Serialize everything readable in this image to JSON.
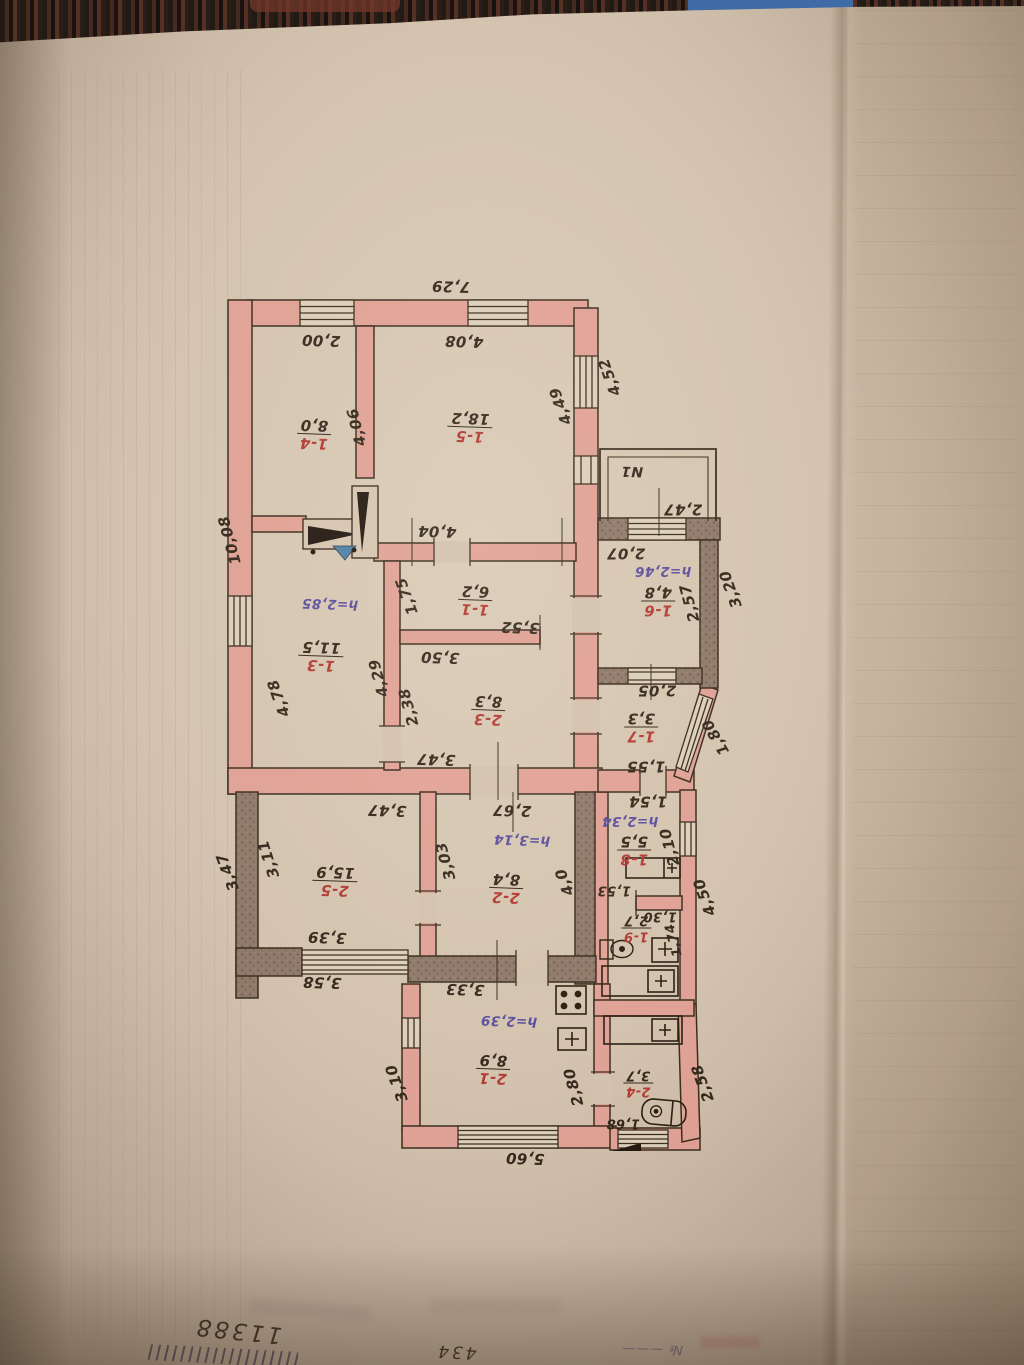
{
  "palette": {
    "paper": "#d2c2ae",
    "wall_pink": "#e0a195",
    "wall_dark": "#8e7869",
    "ink": "#33281b",
    "room_number_red": "#b23a32",
    "height_note_purple": "#5b4f9e",
    "fabric_blue": "#3f6ba6"
  },
  "icons": [
    {
      "name": "cooker-icon",
      "shape": "square-with-four-dots"
    },
    {
      "name": "heater-icon",
      "shape": "square-with-plus"
    },
    {
      "name": "toilet-icon",
      "shape": "cistern-and-bowl"
    },
    {
      "name": "sink-icon",
      "shape": "rounded-basin-with-drain"
    },
    {
      "name": "masonry-stove-icon",
      "shape": "black-wedge-pair-with-blue-triangle"
    },
    {
      "name": "window-vent-icon",
      "shape": "long-rect-with-plus-cell"
    }
  ],
  "plan": {
    "note": "hand-drawn BTI floor plan photographed upside down; all lettering appears rotated 180 degrees",
    "labels": [
      {
        "name": "dim-total-top",
        "kind": "dim",
        "text": "7,29",
        "x": 451,
        "y": 286,
        "rot": 182
      },
      {
        "name": "dim-1-4-width",
        "kind": "dim",
        "text": "2,00",
        "x": 321,
        "y": 340,
        "rot": 182
      },
      {
        "name": "dim-1-5-width",
        "kind": "dim",
        "text": "4,08",
        "x": 464,
        "y": 341,
        "rot": 182
      },
      {
        "name": "dim-right-outer-upper",
        "kind": "dim",
        "text": "4,52",
        "x": 610,
        "y": 377,
        "rot": 250
      },
      {
        "name": "dim-1-5-depth",
        "kind": "dim",
        "text": "4,49",
        "x": 561,
        "y": 406,
        "rot": 250
      },
      {
        "name": "dim-1-4-depth",
        "kind": "dim",
        "text": "4,06",
        "x": 357,
        "y": 427,
        "rot": 256
      },
      {
        "name": "dim-left-outer-upper",
        "kind": "dim",
        "text": "10,08",
        "x": 230,
        "y": 540,
        "rot": 255
      },
      {
        "name": "dim-1-1-width-top",
        "kind": "dim",
        "text": "4,04",
        "x": 437,
        "y": 531,
        "rot": 182
      },
      {
        "name": "veranda-label",
        "kind": "dim",
        "text": "N1",
        "x": 632,
        "y": 471,
        "rot": 182,
        "size": 14
      },
      {
        "name": "dim-veranda-width",
        "kind": "dim",
        "text": "2,47",
        "x": 683,
        "y": 509,
        "rot": 180
      },
      {
        "name": "dim-1-6-window",
        "kind": "dim",
        "text": "2,07",
        "x": 626,
        "y": 553,
        "rot": 180
      },
      {
        "name": "height-1-6",
        "kind": "height",
        "text": "h=2,46",
        "x": 663,
        "y": 570,
        "rot": 180
      },
      {
        "name": "dim-1-6-depth",
        "kind": "dim",
        "text": "2,57",
        "x": 690,
        "y": 603,
        "rot": 255
      },
      {
        "name": "dim-annex-outer-right",
        "kind": "dim",
        "text": "3,20",
        "x": 731,
        "y": 589,
        "rot": 250
      },
      {
        "name": "dim-1-1-left",
        "kind": "dim",
        "text": "1,75",
        "x": 407,
        "y": 596,
        "rot": 250
      },
      {
        "name": "dim-1-1-width-bottom",
        "kind": "dim",
        "text": "3,52",
        "x": 520,
        "y": 627,
        "rot": 182
      },
      {
        "name": "height-1-3",
        "kind": "height",
        "text": "h=2,85",
        "x": 330,
        "y": 603,
        "rot": 182
      },
      {
        "name": "dim-1-6-bottom-window",
        "kind": "dim",
        "text": "2,05",
        "x": 657,
        "y": 690,
        "rot": 180
      },
      {
        "name": "dim-2-3-width-top",
        "kind": "dim",
        "text": "3,50",
        "x": 440,
        "y": 657,
        "rot": 182
      },
      {
        "name": "dim-2-3-left",
        "kind": "dim",
        "text": "2,38",
        "x": 409,
        "y": 707,
        "rot": 255
      },
      {
        "name": "dim-1-3-right",
        "kind": "dim",
        "text": "4,29",
        "x": 379,
        "y": 678,
        "rot": 255
      },
      {
        "name": "dim-1-3-left",
        "kind": "dim",
        "text": "4,78",
        "x": 279,
        "y": 698,
        "rot": 250
      },
      {
        "name": "dim-diagonal-wall",
        "kind": "dim",
        "text": "1,80",
        "x": 716,
        "y": 737,
        "rot": 240
      },
      {
        "name": "dim-1-7-bottom",
        "kind": "dim",
        "text": "1,55",
        "x": 646,
        "y": 766,
        "rot": 180
      },
      {
        "name": "dim-2-3-width-bottom",
        "kind": "dim",
        "text": "3,47",
        "x": 436,
        "y": 759,
        "rot": 182
      },
      {
        "name": "dim-1-8-top",
        "kind": "dim",
        "text": "1,54",
        "x": 648,
        "y": 801,
        "rot": 180
      },
      {
        "name": "height-1-8",
        "kind": "height",
        "text": "h=2,34",
        "x": 630,
        "y": 820,
        "rot": 180
      },
      {
        "name": "dim-1-8-right",
        "kind": "dim",
        "text": "2,10",
        "x": 670,
        "y": 847,
        "rot": 255
      },
      {
        "name": "dim-right-outer-lower",
        "kind": "dim",
        "text": "4,50",
        "x": 705,
        "y": 897,
        "rot": 250
      },
      {
        "name": "dim-1-9-top",
        "kind": "dim",
        "text": "1,53",
        "x": 614,
        "y": 890,
        "rot": 180,
        "size": 13
      },
      {
        "name": "dim-1-9-niche",
        "kind": "dim",
        "text": "1,30",
        "x": 660,
        "y": 916,
        "rot": 180,
        "size": 13
      },
      {
        "name": "dim-1-9-right",
        "kind": "dim",
        "text": "1,74",
        "x": 674,
        "y": 940,
        "rot": 255,
        "size": 13
      },
      {
        "name": "dim-2-5-width-top",
        "kind": "dim",
        "text": "3,47",
        "x": 387,
        "y": 810,
        "rot": 182
      },
      {
        "name": "dim-2-2-width-top",
        "kind": "dim",
        "text": "2,67",
        "x": 512,
        "y": 810,
        "rot": 182
      },
      {
        "name": "height-2-2",
        "kind": "height",
        "text": "h=3,14",
        "x": 522,
        "y": 839,
        "rot": 182
      },
      {
        "name": "dim-2-5-left",
        "kind": "dim",
        "text": "3,11",
        "x": 269,
        "y": 859,
        "rot": 252
      },
      {
        "name": "dim-left-outer-lower",
        "kind": "dim",
        "text": "3,47",
        "x": 228,
        "y": 872,
        "rot": 250
      },
      {
        "name": "dim-2-2-left",
        "kind": "dim",
        "text": "3,03",
        "x": 446,
        "y": 861,
        "rot": 255
      },
      {
        "name": "dim-2-2-right",
        "kind": "dim",
        "text": "4,0",
        "x": 565,
        "y": 882,
        "rot": 250
      },
      {
        "name": "dim-2-5-window",
        "kind": "dim",
        "text": "3,39",
        "x": 327,
        "y": 937,
        "rot": 182
      },
      {
        "name": "dim-2-5-outer-bottom",
        "kind": "dim",
        "text": "3,58",
        "x": 322,
        "y": 982,
        "rot": 182
      },
      {
        "name": "dim-2-1-top",
        "kind": "dim",
        "text": "3,33",
        "x": 465,
        "y": 989,
        "rot": 182
      },
      {
        "name": "height-2-1",
        "kind": "height",
        "text": "h=2,39",
        "x": 509,
        "y": 1020,
        "rot": 182
      },
      {
        "name": "dim-2-1-left",
        "kind": "dim",
        "text": "3,10",
        "x": 397,
        "y": 1083,
        "rot": 250
      },
      {
        "name": "dim-2-1-right",
        "kind": "dim",
        "text": "2,80",
        "x": 574,
        "y": 1087,
        "rot": 255
      },
      {
        "name": "dim-2-4-window",
        "kind": "dim",
        "text": "1,68",
        "x": 623,
        "y": 1123,
        "rot": 180,
        "size": 13
      },
      {
        "name": "dim-bottom-outer",
        "kind": "dim",
        "text": "5,60",
        "x": 525,
        "y": 1158,
        "rot": 182
      },
      {
        "name": "dim-2-4-outer-right",
        "kind": "dim",
        "text": "2,58",
        "x": 703,
        "y": 1083,
        "rot": 250
      },
      {
        "name": "room-1-4",
        "kind": "room",
        "num": "1-4",
        "area": "8,0",
        "x": 314,
        "y": 434,
        "rot": 182
      },
      {
        "name": "room-1-5",
        "kind": "room",
        "num": "1-5",
        "area": "18,2",
        "x": 470,
        "y": 427,
        "rot": 182
      },
      {
        "name": "room-1-6",
        "kind": "room",
        "num": "1-6",
        "area": "4,8",
        "x": 658,
        "y": 601,
        "rot": 180
      },
      {
        "name": "room-1-1",
        "kind": "room",
        "num": "1-1",
        "area": "6,2",
        "x": 475,
        "y": 600,
        "rot": 182
      },
      {
        "name": "room-1-3",
        "kind": "room",
        "num": "1-3",
        "area": "11,5",
        "x": 321,
        "y": 656,
        "rot": 182
      },
      {
        "name": "room-2-3",
        "kind": "room",
        "num": "2-3",
        "area": "8,3",
        "x": 488,
        "y": 710,
        "rot": 182
      },
      {
        "name": "room-1-7",
        "kind": "room",
        "num": "1-7",
        "area": "3,3",
        "x": 641,
        "y": 727,
        "rot": 180
      },
      {
        "name": "room-1-8",
        "kind": "room",
        "num": "1-8",
        "area": "5,5",
        "x": 634,
        "y": 850,
        "rot": 180
      },
      {
        "name": "room-1-9",
        "kind": "room",
        "num": "1-9",
        "area": "2,7",
        "x": 636,
        "y": 928,
        "rot": 180,
        "size": 13
      },
      {
        "name": "room-2-5",
        "kind": "room",
        "num": "2-5",
        "area": "15,9",
        "x": 335,
        "y": 881,
        "rot": 182
      },
      {
        "name": "room-2-2",
        "kind": "room",
        "num": "2-2",
        "area": "8,4",
        "x": 506,
        "y": 888,
        "rot": 182
      },
      {
        "name": "room-2-1",
        "kind": "room",
        "num": "2-1",
        "area": "8,9",
        "x": 493,
        "y": 1069,
        "rot": 182
      },
      {
        "name": "room-2-4",
        "kind": "room",
        "num": "2-4",
        "area": "3,7",
        "x": 638,
        "y": 1083,
        "rot": 180,
        "size": 13
      },
      {
        "name": "inventory-number",
        "kind": "hand",
        "text": "11388",
        "x": 238,
        "y": 1330,
        "rot": 186,
        "size": 23
      },
      {
        "name": "case-number",
        "kind": "hand",
        "text": "434",
        "x": 456,
        "y": 1351,
        "rot": 183,
        "size": 17
      },
      {
        "name": "stamp-number-sign",
        "kind": "stamp",
        "text": "№ ———",
        "x": 652,
        "y": 1349,
        "rot": 181,
        "size": 13
      }
    ]
  }
}
